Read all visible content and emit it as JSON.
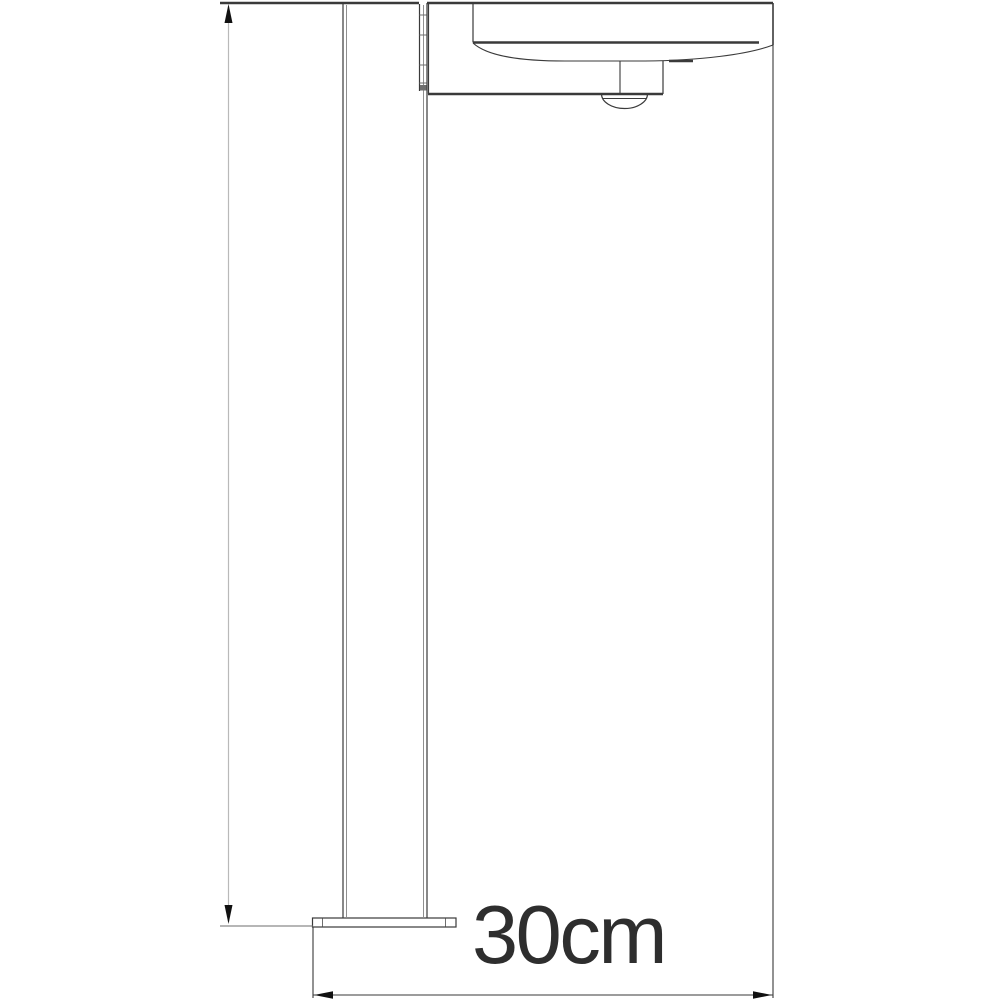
{
  "page": {
    "width": 1000,
    "height": 1000,
    "background": "#ffffff"
  },
  "diagram": {
    "kind": "technical-line-drawing",
    "subject": "Outdoor bollard light with motion sensor, side elevation dimension drawing",
    "parts": {
      "post": "square post",
      "hinge": "post hinge strip",
      "lamp_arm": "lamp arm bracket",
      "lamp_head": "flat lamp head with curved diffuser",
      "sensor": "motion sensor dome",
      "base_plate": "floor base plate"
    },
    "dimensions": {
      "width_label": "30cm"
    },
    "colors": {
      "background": "#ffffff",
      "line_dark": "#3a3a3a",
      "line_medium": "#6e6e6e",
      "line_inner": "#8f8f8f",
      "line_light": "#b9b9b9",
      "arrow_fill": "#111111",
      "text": "#2e2e2e"
    }
  }
}
